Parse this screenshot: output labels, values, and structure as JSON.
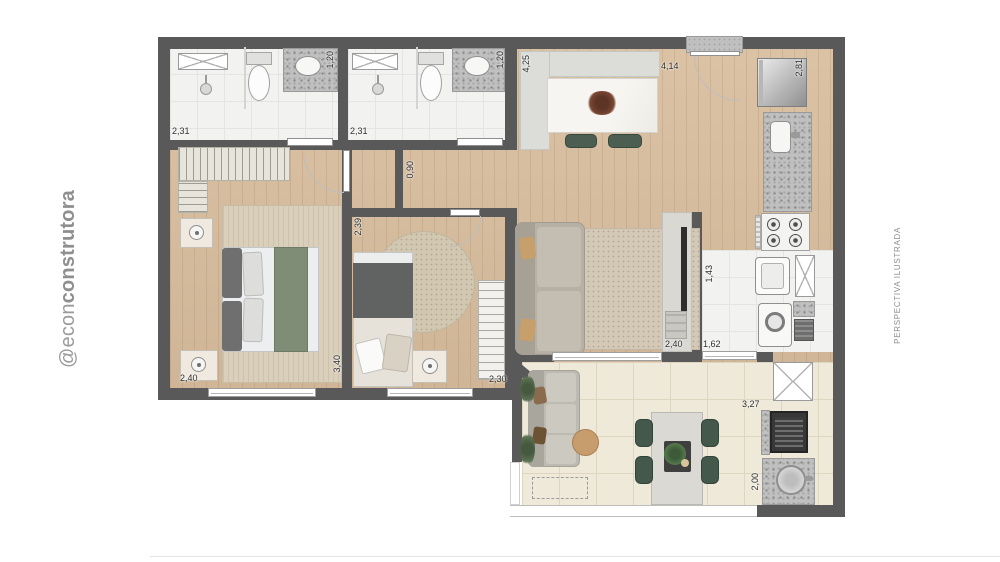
{
  "branding": {
    "handle_regular": "@econ",
    "handle_bold": "construtora",
    "note_right": "PERSPECTIVA ILUSTRADA"
  },
  "dimensions": {
    "bath1_width": "2,31",
    "bath1_depth": "1,20",
    "bath2_width": "2,31",
    "bath2_depth": "1,20",
    "kitchen_depth": "4,25",
    "kitchen_width": "4,14",
    "kitchen_counter_run": "2,81",
    "hall_width": "0,90",
    "bedroom1_width": "2,40",
    "bedroom1_length": "3,40",
    "bedroom2_depth": "2,39",
    "bedroom2_width": "2,30",
    "living_tv_wall": "2,40",
    "laundry_depth": "1,43",
    "laundry_width": "1,62",
    "terrace_width": "3,27",
    "terrace_depth": "2,00"
  },
  "colors": {
    "wall": "#595959",
    "wood_floor": "#d8bd9d",
    "bath_tile": "#f2f2f0",
    "terrace_tile": "#efe9d9",
    "granite": "#c0c0c0",
    "accent_green": "#44584b",
    "rug_beige": "#d2c7b2",
    "brand_gray": "#9a9a9a"
  }
}
